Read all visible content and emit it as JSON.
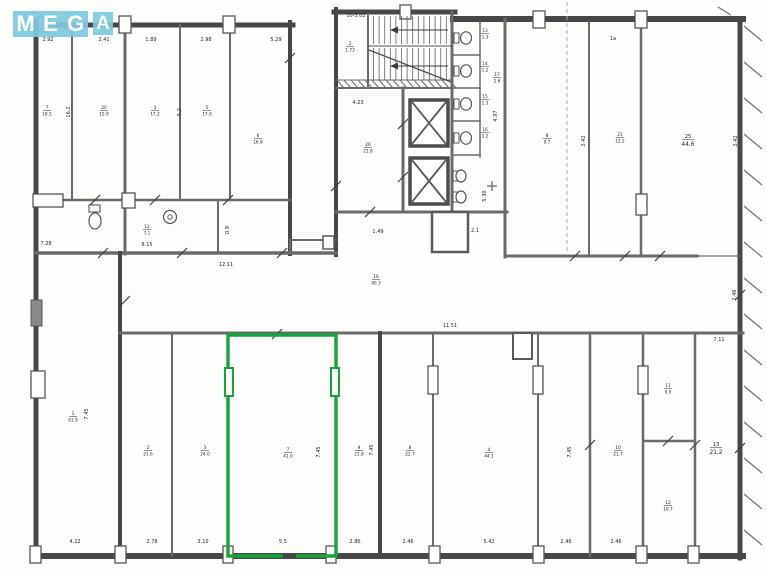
{
  "logo": {
    "letters": [
      "M",
      "E",
      "G",
      "A"
    ],
    "block_color": "#7ecadd",
    "text_color": "#ffffff"
  },
  "highlight": {
    "color": "#17a23b"
  },
  "plan": {
    "room_labels": [
      {
        "num": "7",
        "area": "18.5",
        "x": 47,
        "y": 110
      },
      {
        "num": "20",
        "area": "15.9",
        "x": 104,
        "y": 110
      },
      {
        "num": "3",
        "area": "17.2",
        "x": 155,
        "y": 110
      },
      {
        "num": "5",
        "area": "17.9",
        "x": 207,
        "y": 110
      },
      {
        "num": "6",
        "area": "16.8",
        "x": 258,
        "y": 138
      },
      {
        "num": "12",
        "area": "7.1",
        "x": 147,
        "y": 229
      },
      {
        "num": "2",
        "area": "1.73",
        "x": 350,
        "y": 46
      },
      {
        "num": "26",
        "area": "21.8",
        "x": 368,
        "y": 147
      },
      {
        "num": "13",
        "area": "1.3",
        "x": 485,
        "y": 33
      },
      {
        "num": "14",
        "area": "1.2",
        "x": 485,
        "y": 66
      },
      {
        "num": "15",
        "area": "1.3",
        "x": 485,
        "y": 99
      },
      {
        "num": "16",
        "area": "1.2",
        "x": 485,
        "y": 132
      },
      {
        "num": "17",
        "area": "2.6",
        "x": 497,
        "y": 77
      },
      {
        "num": "8",
        "area": "9.7",
        "x": 547,
        "y": 138
      },
      {
        "num": "21",
        "area": "12.2",
        "x": 620,
        "y": 137
      },
      {
        "num": "25",
        "area": "44,6",
        "x": 688,
        "y": 139,
        "big": true
      },
      {
        "num": "16",
        "area": "90.3",
        "x": 376,
        "y": 279
      },
      {
        "num": "1",
        "area": "61.9",
        "x": 73,
        "y": 416
      },
      {
        "num": "2",
        "area": "21.6",
        "x": 148,
        "y": 450
      },
      {
        "num": "3",
        "area": "24.0",
        "x": 205,
        "y": 450
      },
      {
        "num": "7",
        "area": "41.0",
        "x": 288,
        "y": 452
      },
      {
        "num": "9",
        "area": "21.8",
        "x": 359,
        "y": 450
      },
      {
        "num": "8",
        "area": "22.7",
        "x": 410,
        "y": 450
      },
      {
        "num": "4",
        "area": "44.1",
        "x": 489,
        "y": 452
      },
      {
        "num": "10",
        "area": "21.7",
        "x": 618,
        "y": 450
      },
      {
        "num": "11",
        "area": "9.9",
        "x": 668,
        "y": 388
      },
      {
        "num": "12",
        "area": "10.7",
        "x": 668,
        "y": 505
      },
      {
        "num": "13",
        "area": "21,2",
        "x": 716,
        "y": 447,
        "big": true
      }
    ],
    "dim_labels": [
      {
        "text": "2.92",
        "x": 48,
        "y": 41
      },
      {
        "text": "2.41",
        "x": 104,
        "y": 41
      },
      {
        "text": "1.89",
        "x": 151,
        "y": 41
      },
      {
        "text": "2.98",
        "x": 206,
        "y": 41
      },
      {
        "text": "5.29",
        "x": 276,
        "y": 41
      },
      {
        "text": "16.2",
        "x": 70,
        "y": 112,
        "vert": true
      },
      {
        "text": "5.2",
        "x": 181,
        "y": 112,
        "vert": true
      },
      {
        "text": "7.28",
        "x": 46,
        "y": 245
      },
      {
        "text": "8.15",
        "x": 147,
        "y": 246
      },
      {
        "text": "0.9",
        "x": 229,
        "y": 230,
        "vert": true
      },
      {
        "text": "12.11",
        "x": 226,
        "y": 266
      },
      {
        "text": "10-3.02",
        "x": 356,
        "y": 17
      },
      {
        "text": "4.23",
        "x": 358,
        "y": 104
      },
      {
        "text": "1.49",
        "x": 378,
        "y": 233
      },
      {
        "text": "2.1",
        "x": 475,
        "y": 232
      },
      {
        "text": "5.30",
        "x": 486,
        "y": 196,
        "vert": true
      },
      {
        "text": "4.97",
        "x": 497,
        "y": 116,
        "vert": true
      },
      {
        "text": "1a",
        "x": 613,
        "y": 40
      },
      {
        "text": "2.42",
        "x": 585,
        "y": 141,
        "vert": true
      },
      {
        "text": "2.42",
        "x": 737,
        "y": 141,
        "vert": true
      },
      {
        "text": "11.51",
        "x": 450,
        "y": 327
      },
      {
        "text": "2.46",
        "x": 736,
        "y": 295,
        "vert": true
      },
      {
        "text": "7.11",
        "x": 719,
        "y": 341
      },
      {
        "text": "7.45",
        "x": 88,
        "y": 414,
        "vert": true
      },
      {
        "text": "7.45",
        "x": 320,
        "y": 452,
        "vert": true
      },
      {
        "text": "7.45",
        "x": 373,
        "y": 450,
        "vert": true
      },
      {
        "text": "7.45",
        "x": 571,
        "y": 452,
        "vert": true
      },
      {
        "text": "4.22",
        "x": 75,
        "y": 543
      },
      {
        "text": "2.78",
        "x": 152,
        "y": 543
      },
      {
        "text": "3.10",
        "x": 203,
        "y": 543
      },
      {
        "text": "5.5",
        "x": 283,
        "y": 543
      },
      {
        "text": "2.86",
        "x": 355,
        "y": 543
      },
      {
        "text": "2.46",
        "x": 408,
        "y": 543
      },
      {
        "text": "5.42",
        "x": 489,
        "y": 543
      },
      {
        "text": "2.46",
        "x": 566,
        "y": 543
      },
      {
        "text": "2.46",
        "x": 616,
        "y": 543
      }
    ]
  }
}
